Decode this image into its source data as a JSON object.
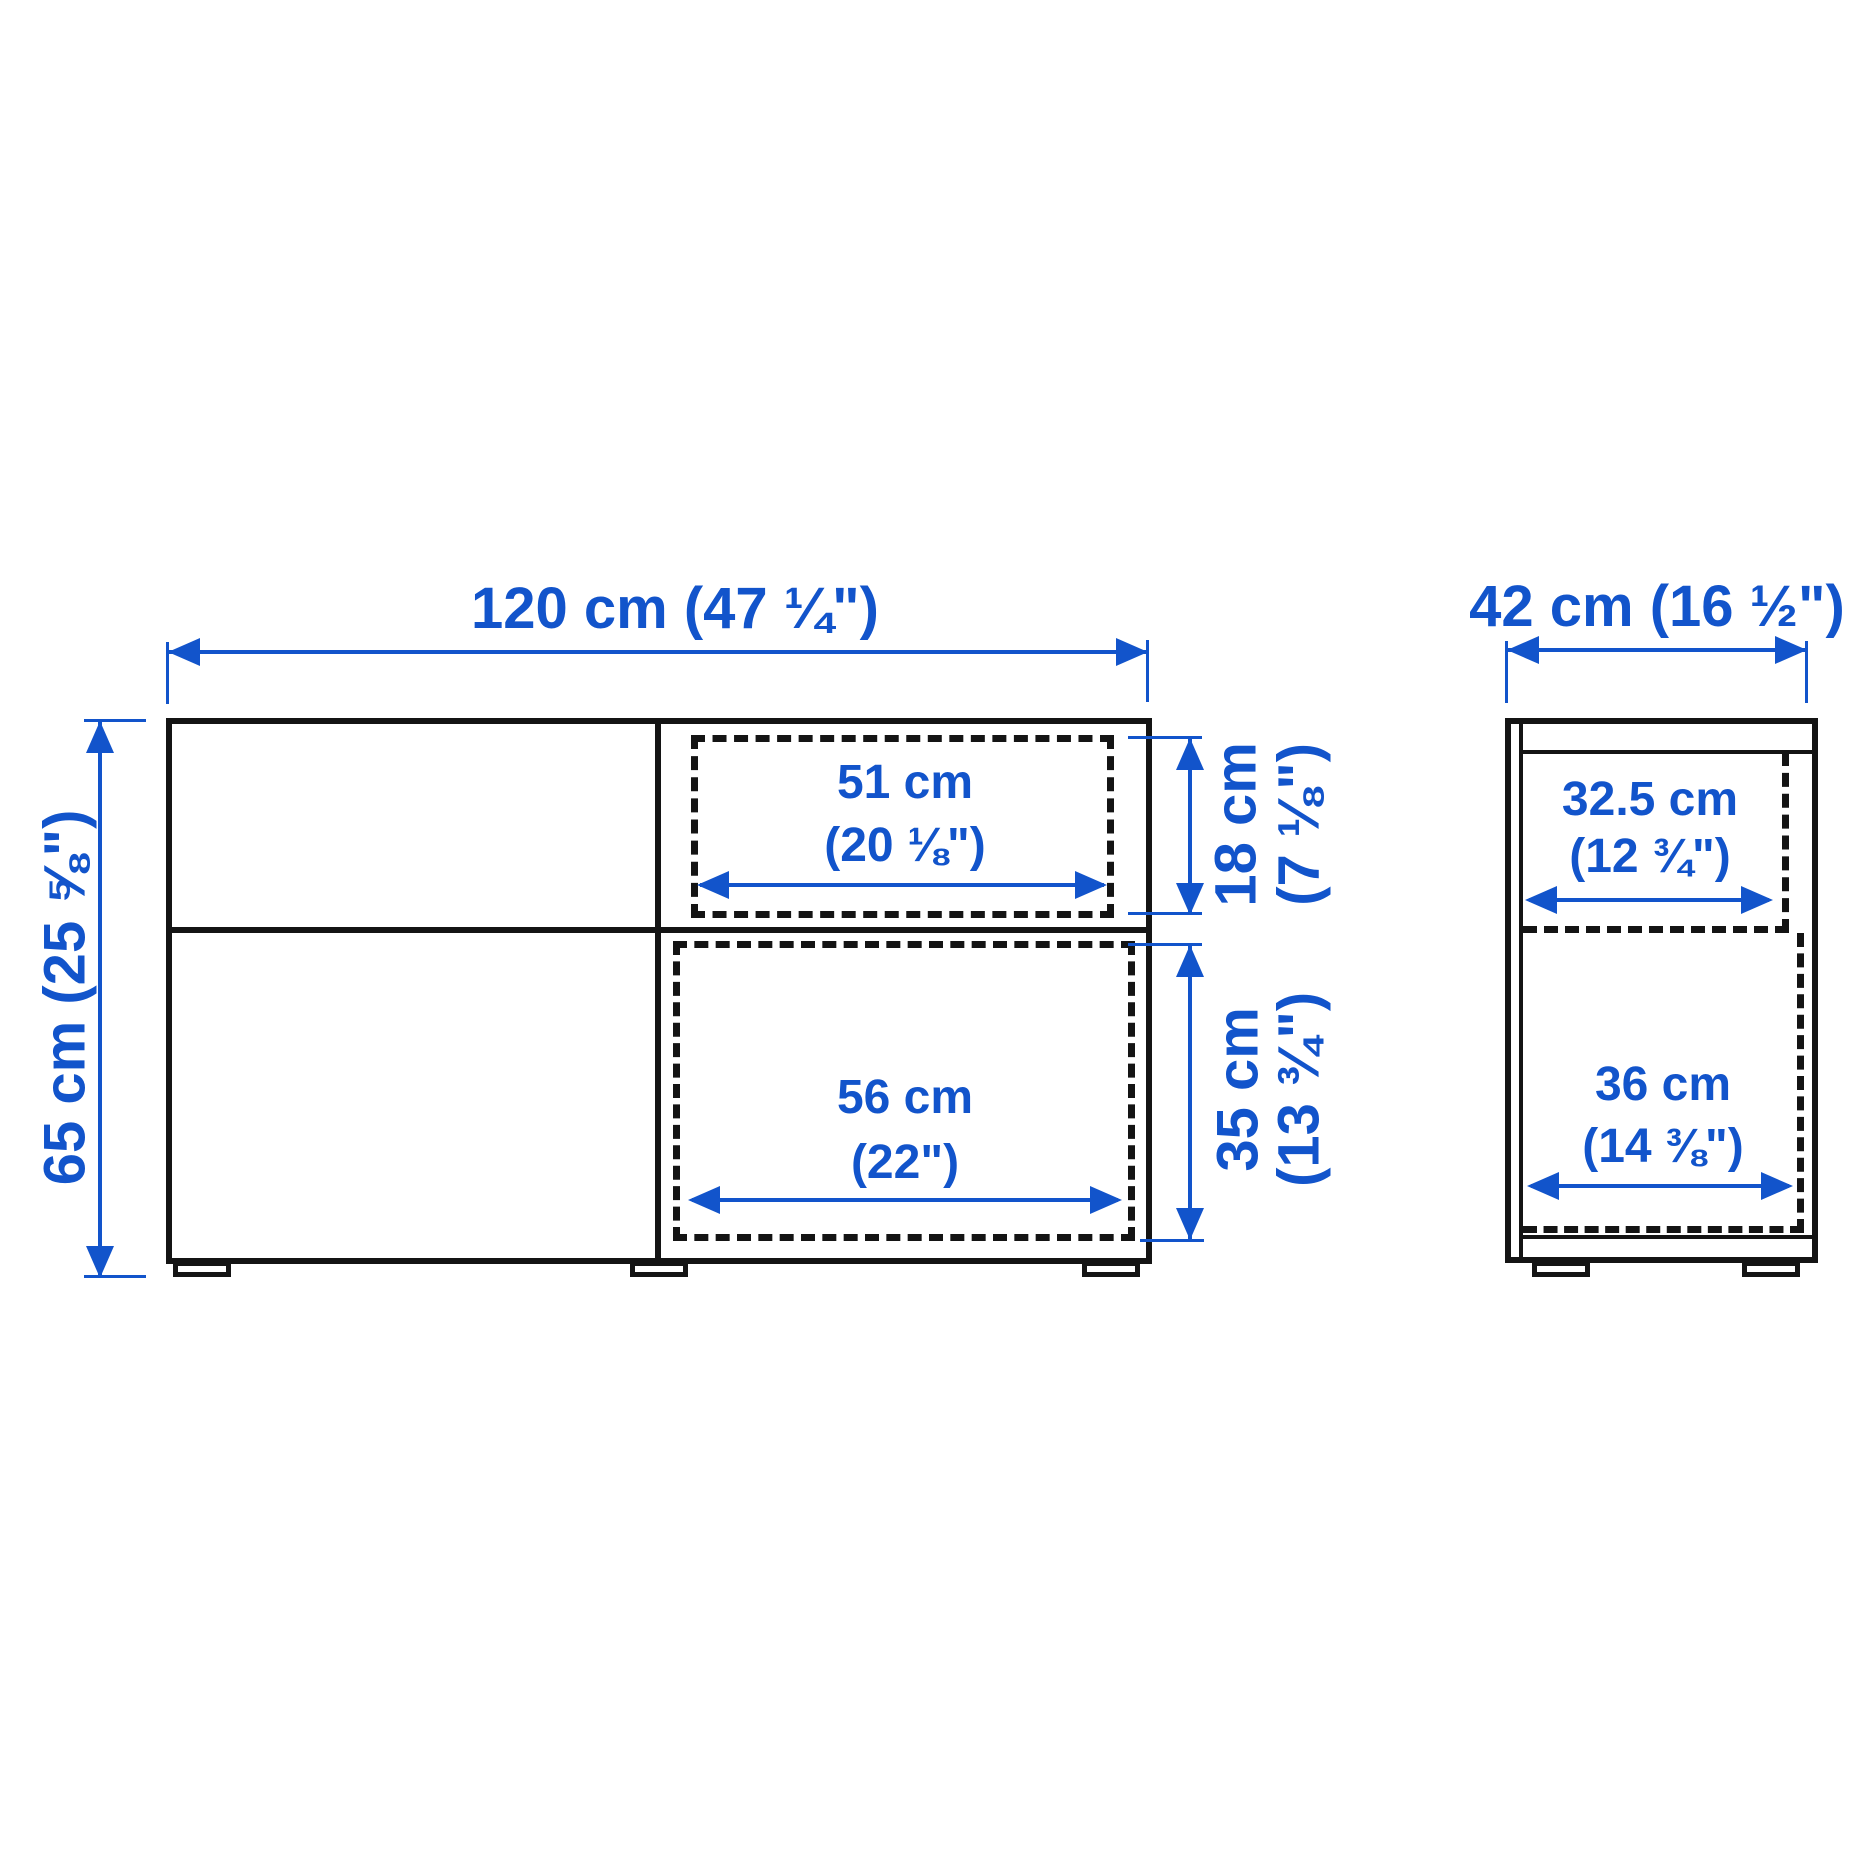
{
  "front_view": {
    "width_label": "120 cm (47 ¼\")",
    "height_label": "65 cm (25 ⅝\")",
    "top_drawer": {
      "width_line1": "51 cm",
      "width_line2": "(20 ⅛\")",
      "height_line1": "18 cm",
      "height_line2": "(7 ⅛\")"
    },
    "bottom_drawer": {
      "width_line1": "56 cm",
      "width_line2": "(22\")",
      "height_line1": "35 cm",
      "height_line2": "(13 ¾\")"
    }
  },
  "side_view": {
    "depth_label": "42 cm (16 ½\")",
    "top_compartment": {
      "width_line1": "32.5 cm",
      "width_line2": "(12 ¾\")"
    },
    "bottom_compartment": {
      "width_line1": "36 cm",
      "width_line2": "(14 ⅜\")"
    }
  },
  "colors": {
    "blue": "#1254cb",
    "black": "#141414"
  }
}
